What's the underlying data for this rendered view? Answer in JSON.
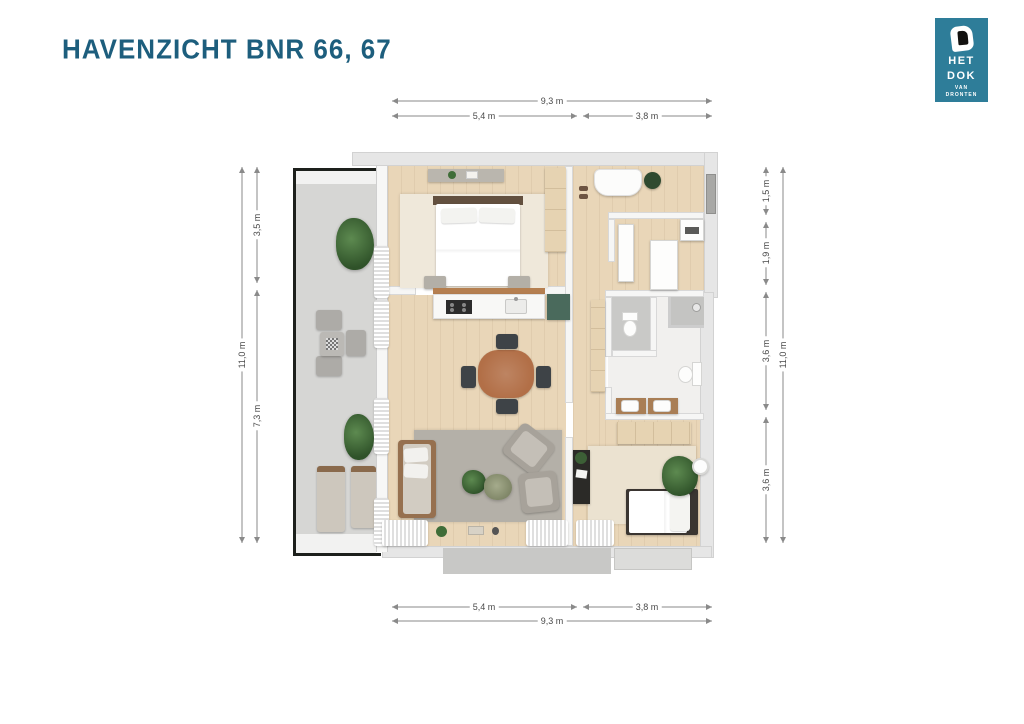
{
  "page": {
    "title": "HAVENZICHT BNR 66, 67"
  },
  "logo": {
    "name_line1": "HET",
    "name_line2": "DOK",
    "sub_line1": "VAN",
    "sub_line2": "DRONTEN"
  },
  "dimensions": {
    "top_total": "9,3 m",
    "top_left": "5,4 m",
    "top_right": "3,8 m",
    "bottom_left": "5,4 m",
    "bottom_right": "3,8 m",
    "bottom_total": "9,3 m",
    "left_total": "11,0 m",
    "left_upper": "3,5 m",
    "left_lower": "7,3 m",
    "right_seg1": "1,5 m",
    "right_seg2": "1,9 m",
    "right_seg3": "3,6 m",
    "right_seg4": "3,6 m",
    "right_total": "11,0 m"
  },
  "colors": {
    "title_text": "#1d5e7d",
    "logo_bg": "#2e7d99",
    "floor_wood": "#e9d6b8",
    "wall_gray": "#e6e6e6",
    "balcony_concrete": "#d6d6d4",
    "rug_gray": "#b4b0a8",
    "sofa_brown": "#96704f",
    "table_brown": "#b26f47",
    "cabinet_green": "#4a6a5c",
    "plant_green": "#3f6d38",
    "dim_line": "#8a8a8a",
    "dim_text": "#4a4a4a"
  }
}
